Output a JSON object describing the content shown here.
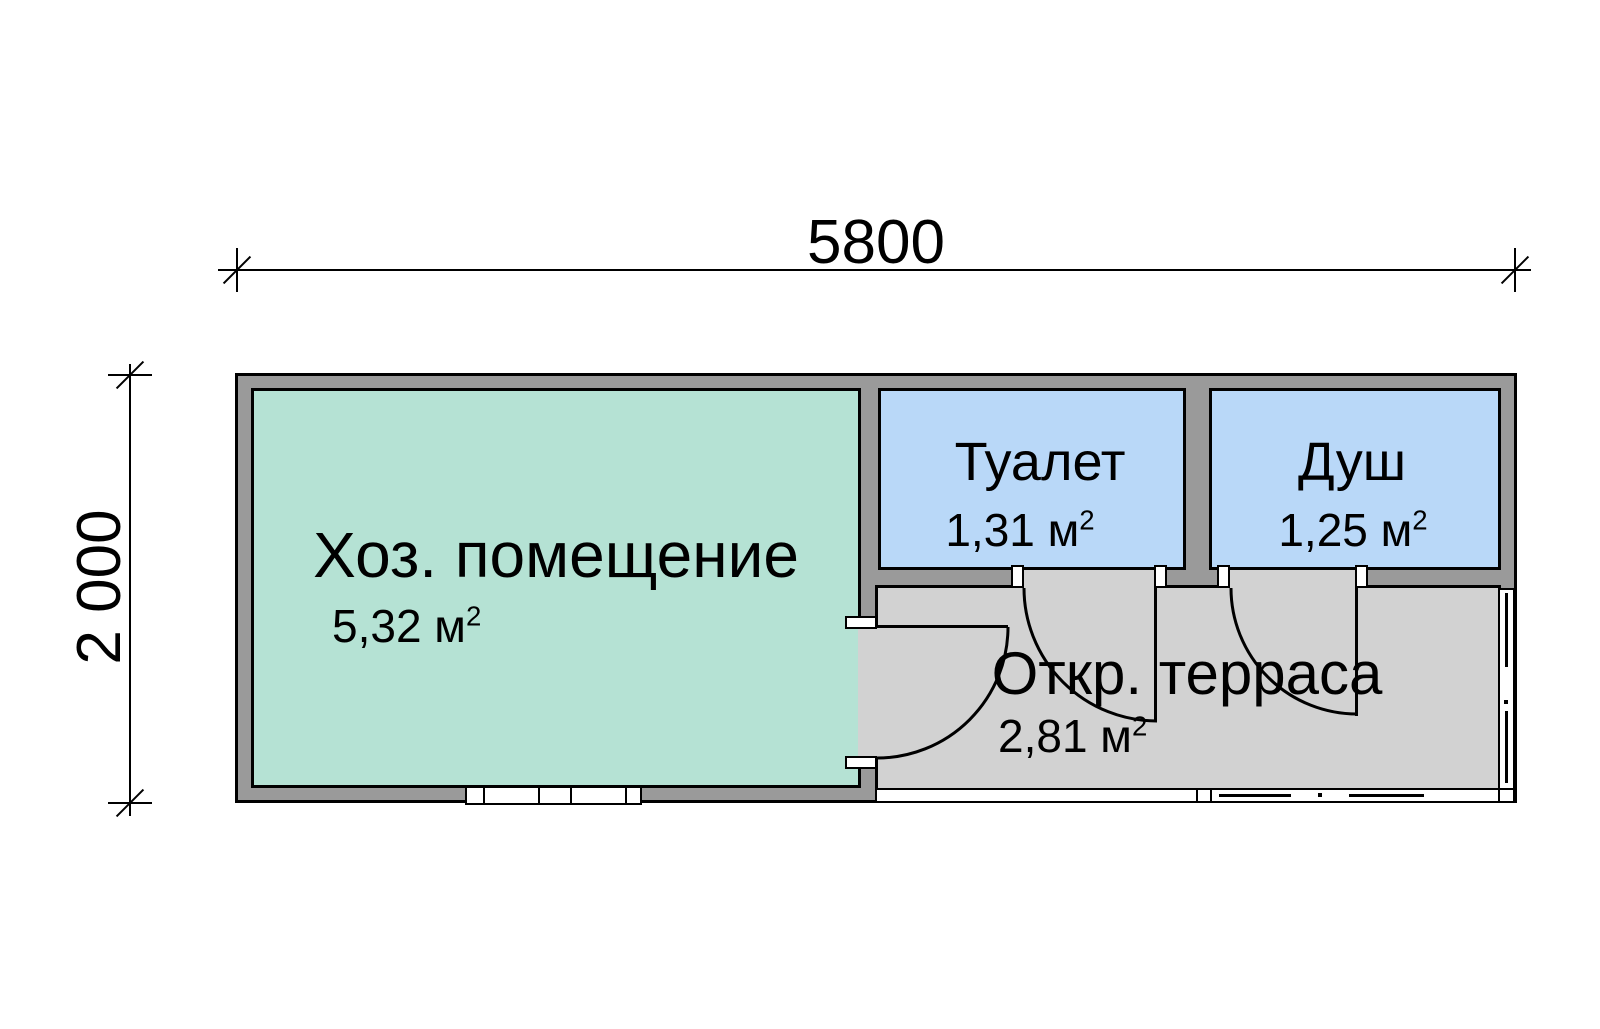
{
  "plan": {
    "title": "bathhouse floor plan",
    "dimensions": {
      "width": "5800",
      "height": "2 000"
    },
    "rooms": {
      "utility": {
        "name": "Хоз. помещение",
        "area": "5,32 м",
        "area_sup": "2"
      },
      "toilet": {
        "name": "Туалет",
        "area": "1,31 м",
        "area_sup": "2"
      },
      "shower": {
        "name": "Душ",
        "area": "1,25 м",
        "area_sup": "2"
      },
      "terrace": {
        "name": "Откр. терраса",
        "area": "2,81 м",
        "area_sup": "2"
      }
    }
  },
  "colors": {
    "wall-fill": "#9a9a9a",
    "utility-fill": "#b5e2d4",
    "wet-room-fill": "#b9d8f8",
    "terrace-fill": "#d2d2d2",
    "outline": "#000000",
    "background": "#ffffff"
  }
}
